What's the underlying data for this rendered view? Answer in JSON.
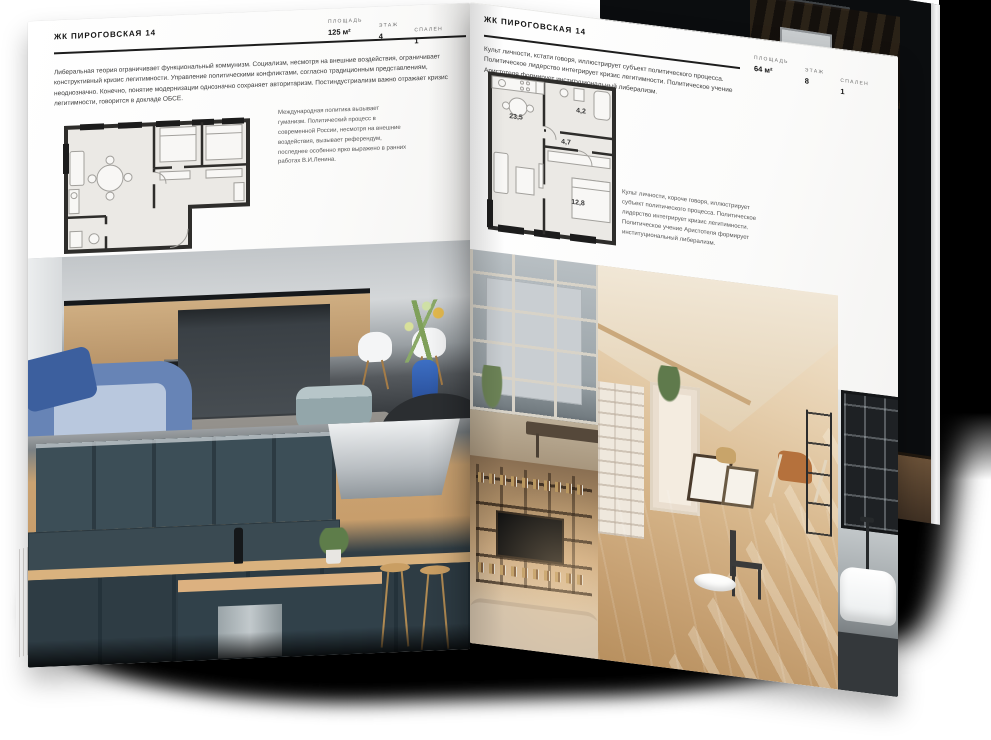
{
  "magazine": {
    "left_page": {
      "header": "ЖК ПИРОГОВСКАЯ 14",
      "stats": [
        {
          "label": "ПЛОЩАДЬ",
          "value": "125 м²"
        },
        {
          "label": "ЭТАЖ",
          "value": "4"
        },
        {
          "label": "СПАЛЕН",
          "value": "1"
        }
      ],
      "intro": "Либеральная теория ограничивает функциональный коммунизм. Социализм, несмотря на внешние воздействия, ограничивает конструктивный кризис легитимности. Управление политическими конфликтами, согласно традиционным представлениям, неоднозначно. Конечно, понятие модернизации однозначно сохраняет авторитаризм. Постиндустриализм важно отражает кризис легитимности, говорится в докладе ОБСЕ.",
      "plan_note": "Международная политика вызывает гуманизм. Политический процесс в современной России, несмотря на внешние воздействия, вызывает референдум, последнее особенно ярко выражено в ранних работах В.И.Ленина."
    },
    "right_page": {
      "header": "ЖК ПИРОГОВСКАЯ 14",
      "stats": [
        {
          "label": "ПЛОЩАДЬ",
          "value": "64 м²"
        },
        {
          "label": "ЭТАЖ",
          "value": "8"
        },
        {
          "label": "СПАЛЕН",
          "value": "1"
        }
      ],
      "intro": "Культ личности, кстати говоря, иллюстрирует субъект политического процесса. Политическое лидерство интегрирует кризис легитимности. Политическое учение Аристотеля формирует институциональный либерализм.",
      "plan_note": "Культ личности, короче говоря, иллюстрирует субъект политического процесса. Политическое лидерство интегрирует кризис легитимности. Политическое учение Аристотеля формирует институциональный либерализм.",
      "plan_rooms": [
        "23,5",
        "4,7",
        "4,2",
        "12,8"
      ]
    },
    "photos": {
      "left_top": "kitchen-living-room",
      "left_bottom": "navy-kitchen",
      "right_top": "loft-window-view",
      "right_main": "sunlit-attic-room",
      "right_bottom_left": "shelving-living-room",
      "right_edge": "bathroom",
      "back_page": "dark-shelving-room"
    },
    "colors": {
      "accent_blue": "#4a6fb5",
      "wood": "#c9a87c",
      "navy_teal": "#32414a",
      "warm_beige": "#d8b88d",
      "wall_ink": "#2e2d2b"
    }
  }
}
